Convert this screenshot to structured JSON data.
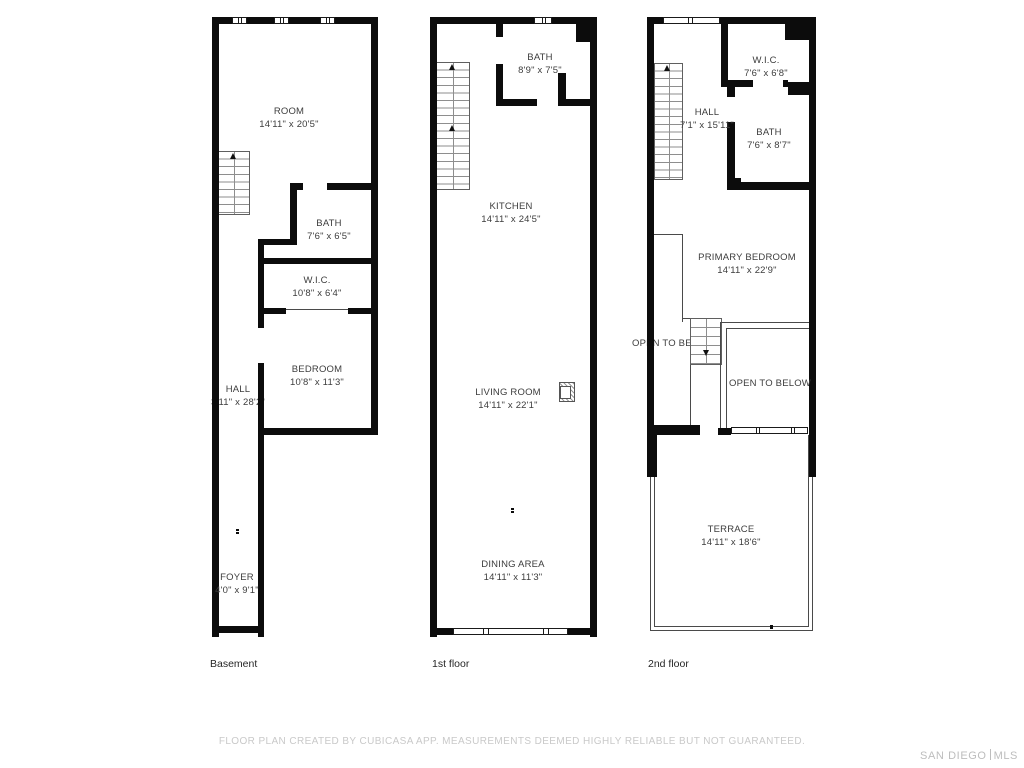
{
  "floors": [
    {
      "id": "basement",
      "caption": "Basement",
      "rooms": [
        {
          "name": "ROOM",
          "dims": "14'11\" x 20'5\""
        },
        {
          "name": "BATH",
          "dims": "7'6\" x 6'5\""
        },
        {
          "name": "W.I.C.",
          "dims": "10'8\" x 6'4\""
        },
        {
          "name": "BEDROOM",
          "dims": "10'8\" x 11'3\""
        },
        {
          "name": "HALL",
          "dims": "3'11\" x 28'2\""
        },
        {
          "name": "FOYER",
          "dims": "4'0\" x 9'1\""
        }
      ]
    },
    {
      "id": "first-floor",
      "caption": "1st floor",
      "rooms": [
        {
          "name": "BATH",
          "dims": "8'9\" x 7'5\""
        },
        {
          "name": "KITCHEN",
          "dims": "14'11\" x 24'5\""
        },
        {
          "name": "LIVING ROOM",
          "dims": "14'11\" x 22'1\""
        },
        {
          "name": "DINING AREA",
          "dims": "14'11\" x 11'3\""
        }
      ]
    },
    {
      "id": "second-floor",
      "caption": "2nd floor",
      "rooms": [
        {
          "name": "W.I.C.",
          "dims": "7'6\" x 6'8\""
        },
        {
          "name": "HALL",
          "dims": "7'1\" x 15'11\""
        },
        {
          "name": "BATH",
          "dims": "7'6\" x 8'7\""
        },
        {
          "name": "PRIMARY BEDROOM",
          "dims": "14'11\" x 22'9\""
        },
        {
          "name": "OPEN TO BELOW",
          "dims": ""
        },
        {
          "name": "OPEN TO BELOW",
          "dims": ""
        },
        {
          "name": "TERRACE",
          "dims": "14'11\" x 18'6\""
        }
      ]
    }
  ],
  "footer": {
    "disclaimer": "FLOOR PLAN CREATED BY CUBICASA APP. MEASUREMENTS DEEMED HIGHLY RELIABLE BUT NOT GUARANTEED."
  },
  "logo": {
    "left": "SAN DIEGO",
    "right": "MLS"
  },
  "icons": {
    "stairs_up": "up-arrow",
    "stairs_down": "down-arrow"
  },
  "colors": {
    "wall": "#0c0c0c",
    "label_text": "#3d3d3d",
    "muted_text": "#c9c9c9"
  }
}
